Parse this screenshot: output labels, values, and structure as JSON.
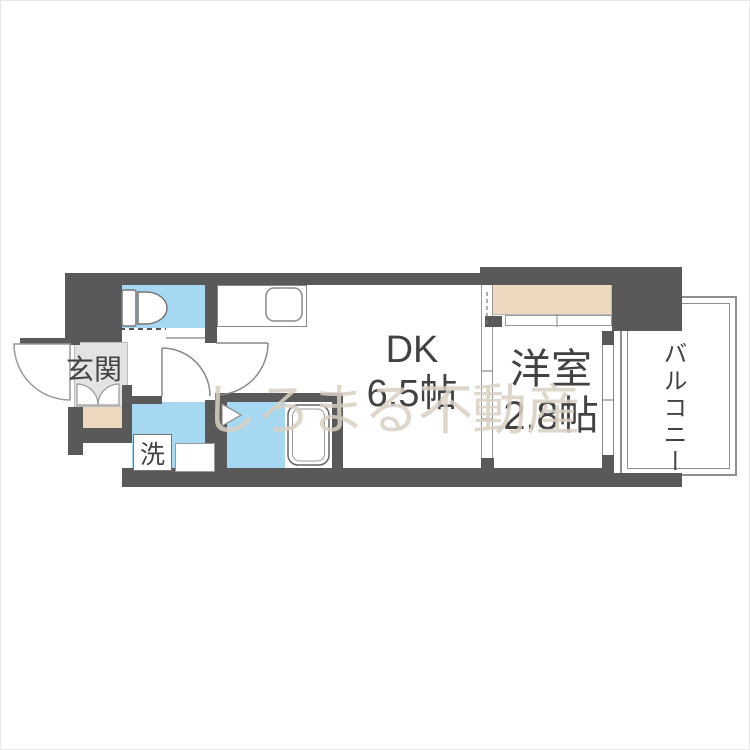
{
  "floorplan": {
    "watermark": "しろまる不動産",
    "labels": {
      "entrance": "玄関",
      "washer": "洗",
      "dk_line1": "DK",
      "dk_line2": "6.5帖",
      "western_line1": "洋室",
      "western_line2": "2.8帖",
      "balcony": "バルコニー"
    },
    "colors": {
      "wall": "#595959",
      "water_area_blue": "#a7d8f1",
      "closet_step_beige": "#edd9c0",
      "entrance_floor_gray": "#e3e3e3",
      "label_text": "#424242",
      "watermark_text": "#d8d0c3",
      "fixture_outline": "#888888"
    }
  }
}
